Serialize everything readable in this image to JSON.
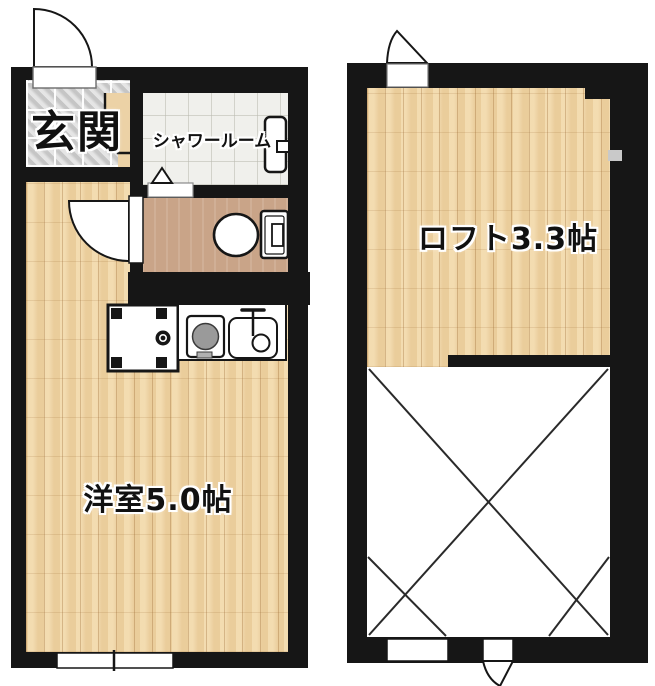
{
  "plan": {
    "rooms": {
      "entrance": {
        "label": "玄関"
      },
      "shower_room": {
        "label": "シャワールーム"
      },
      "western_room": {
        "label": "洋室5.0帖"
      },
      "loft": {
        "label": "ロフト3.3帖"
      }
    },
    "fixtures": [
      "entrance-door",
      "entrance-step",
      "shower-step",
      "shower-unit",
      "toilet",
      "toilet-door",
      "washing-machine-pan",
      "stove",
      "kitchen-sink",
      "main-room-window",
      "loft-casement-window",
      "loft-bottom-window",
      "loft-bottom-door",
      "void-x-mark"
    ],
    "colors": {
      "wall": "#161616",
      "wood_floor": "#f0d4a2",
      "entrance_tile": "#d4d4d4",
      "shower_tile": "#f0f0ec",
      "toilet_floor": "#c9a488",
      "fixture_white": "#ffffff"
    }
  }
}
